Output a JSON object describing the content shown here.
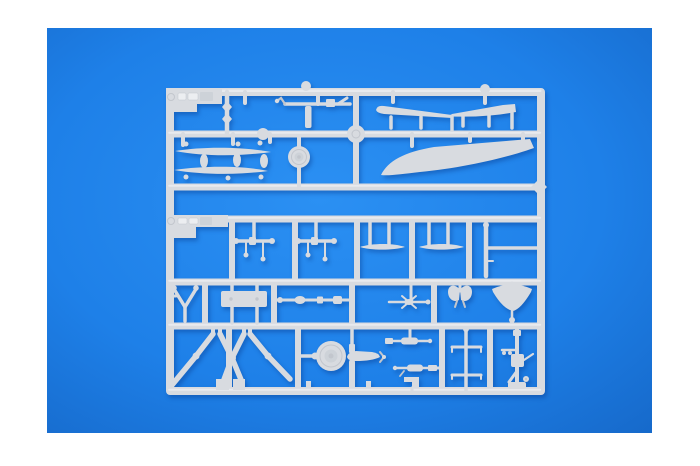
{
  "meta": {
    "subject": "Photograph of a light grey injection-moulded model kit sprue (parts frame) lying on a bright blue backdrop with white borders",
    "media": "product photo",
    "visible_text": "embossed markings on sprue tabs (illegible)"
  },
  "colors": {
    "page_bg": "#ffffff",
    "backdrop": "#1e80e8",
    "backdrop_light": "#2b90f3",
    "backdrop_dark": "#1566c6",
    "plastic": "#d8dbe0",
    "plastic_light": "#eceef1",
    "plastic_mid": "#cdd2d8",
    "plastic_dark": "#c2c6cd"
  },
  "sprue": {
    "material": "light grey styrene",
    "parts": [
      "tiller-rod-assembly",
      "knotted-gate-beads",
      "float-blade-1",
      "float-blade-2",
      "oval-blisters",
      "small-wheel-pulley",
      "stabilizer-fin-left",
      "stabilizer-fin-right",
      "boat-hull-half",
      "axle-with-pins-1",
      "axle-with-pins-2",
      "ski-float-1",
      "ski-float-2",
      "ladder-hook",
      "mount-yoke",
      "rectangular-plate",
      "drive-shaft",
      "swivel-cross",
      "bat-wing-bracket",
      "gun-shield",
      "tripod-strut-legs",
      "road-wheel",
      "torpedo-body",
      "machine-gun-1",
      "machine-gun-2",
      "l-bracket",
      "signal-mast",
      "pedestal-machine-gun"
    ]
  }
}
